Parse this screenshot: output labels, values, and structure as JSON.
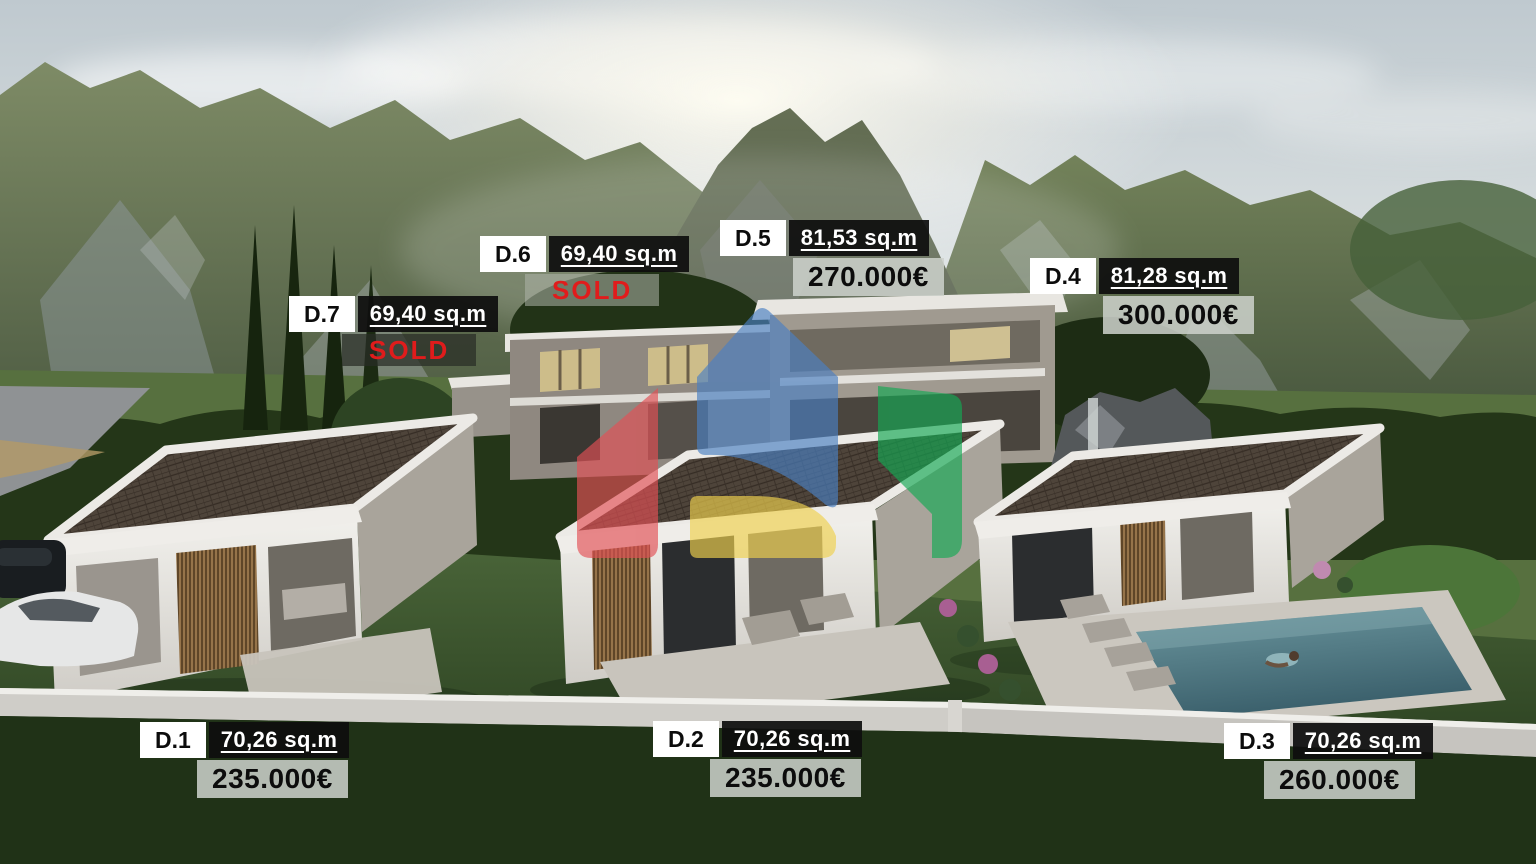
{
  "properties": [
    {
      "id": "D.1",
      "area": "70,26 sq.m",
      "price": "235.000€"
    },
    {
      "id": "D.2",
      "area": "70,26 sq.m",
      "price": "235.000€"
    },
    {
      "id": "D.3",
      "area": "70,26 sq.m",
      "price": "260.000€"
    },
    {
      "id": "D.4",
      "area": "81,28 sq.m",
      "price": "300.000€"
    },
    {
      "id": "D.5",
      "area": "81,53 sq.m",
      "price": "270.000€"
    },
    {
      "id": "D.6",
      "area": "69,40 sq.m",
      "status": "SOLD"
    },
    {
      "id": "D.7",
      "area": "69,40 sq.m",
      "status": "SOLD"
    }
  ],
  "colors": {
    "sold_text": "#e01c1c",
    "id_tag_bg": "#ffffff",
    "area_tag_bg": "#0e0e0e",
    "price_tag_bg": "#ccd1cc",
    "logo_red": "#e25055",
    "logo_blue": "#4a80c2",
    "logo_yellow": "#f0d14e",
    "logo_green": "#14a853"
  }
}
